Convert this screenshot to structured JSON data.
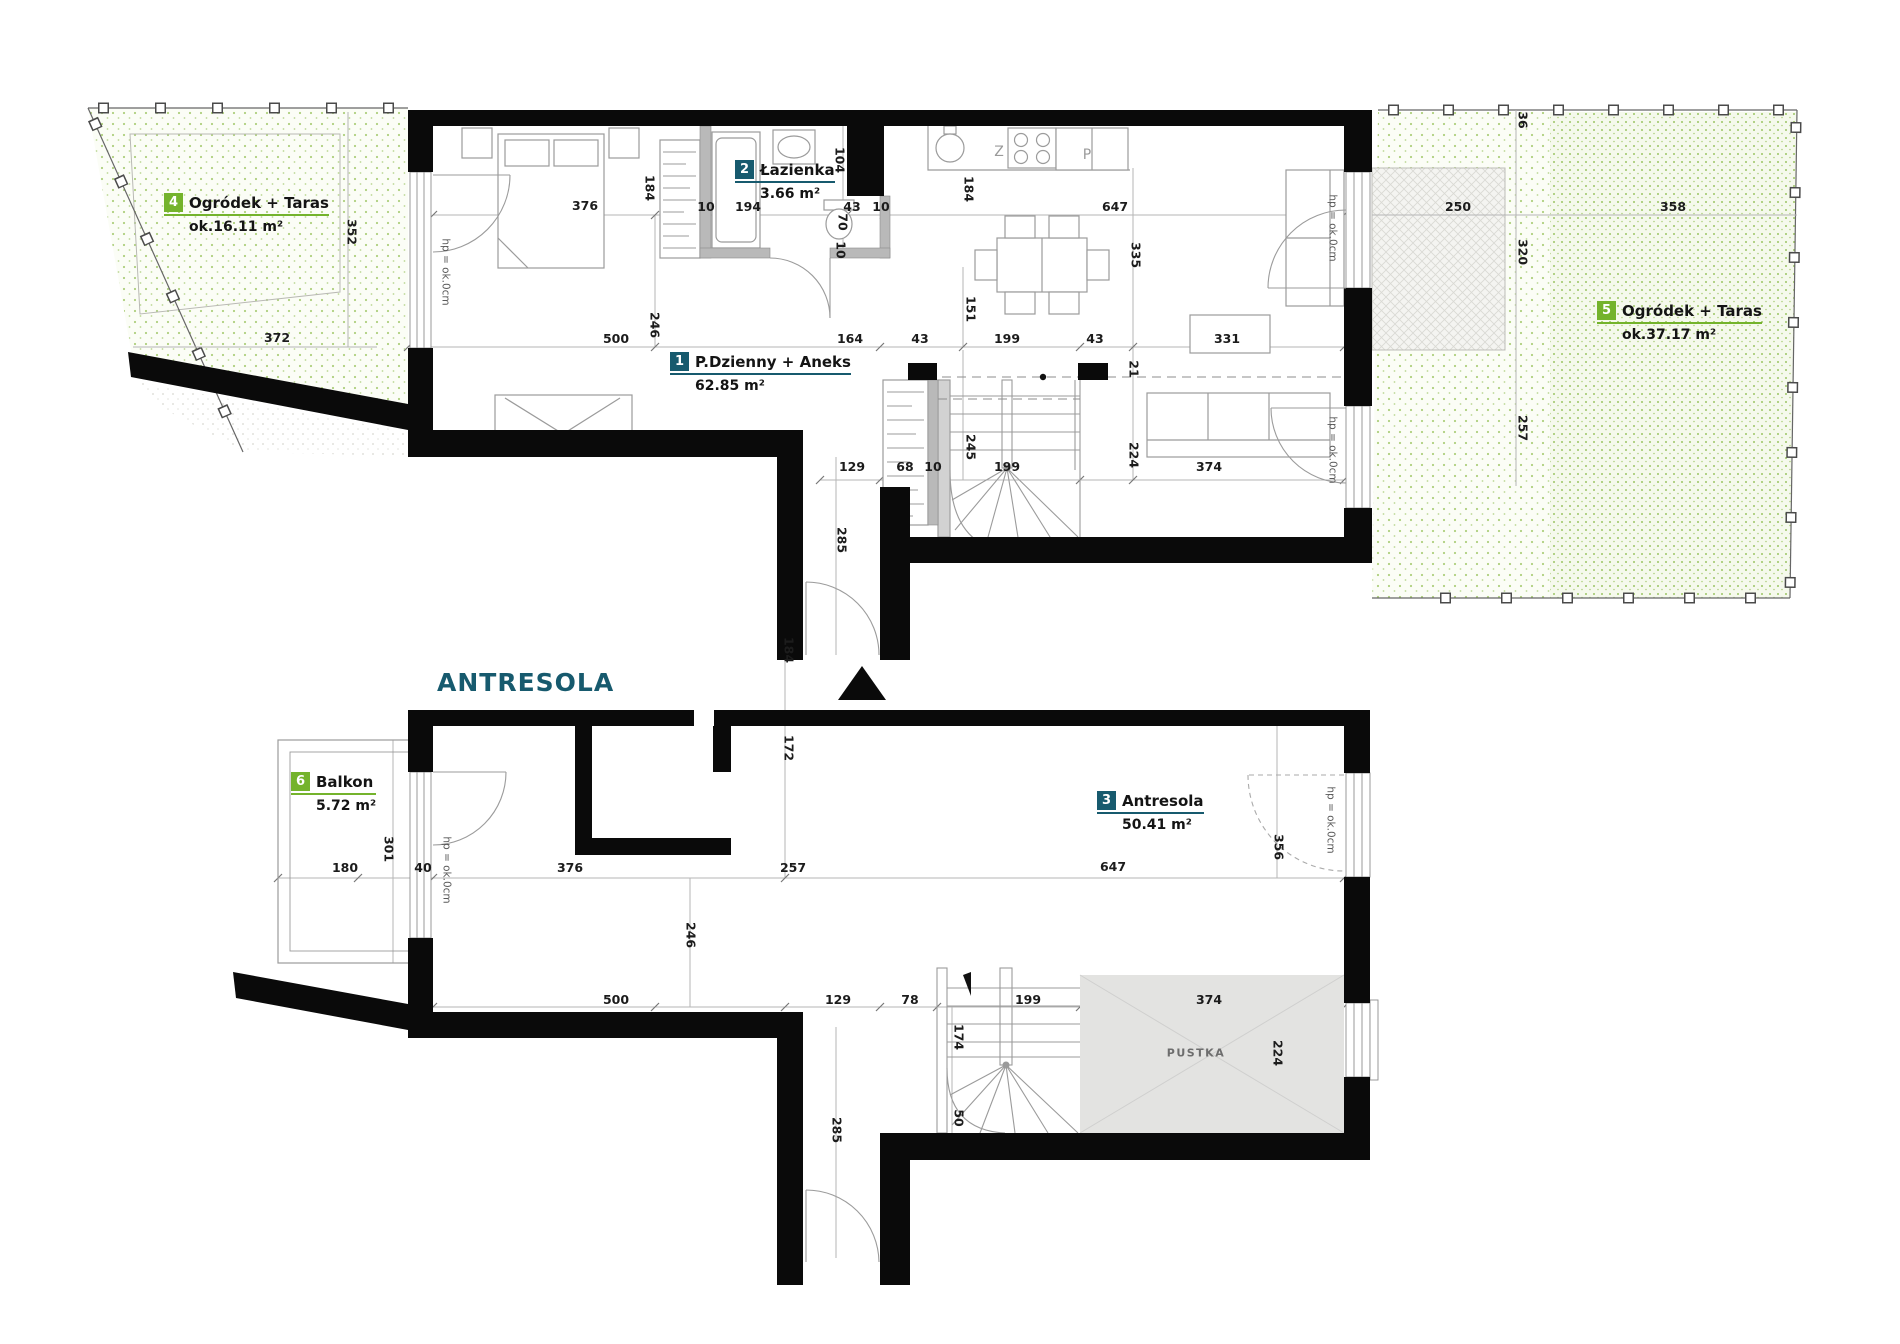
{
  "level_title": "ANTRESOLA",
  "colors": {
    "badge_green": "#74b32c",
    "badge_teal": "#175a6e",
    "wall": "#0a0a0a",
    "garden_dot": "#aecf7e",
    "pustka_fill": "#e3e3e1"
  },
  "rooms": {
    "r1": {
      "num": "1",
      "name": "P.Dzienny + Aneks",
      "area": "62.85 m²"
    },
    "r2": {
      "num": "2",
      "name": "Łazienka",
      "area": "3.66 m²"
    },
    "r3": {
      "num": "3",
      "name": "Antresola",
      "area": "50.41 m²"
    },
    "r4": {
      "num": "4",
      "name": "Ogródek + Taras",
      "area": "ok.16.11 m²"
    },
    "r5": {
      "num": "5",
      "name": "Ogródek + Taras",
      "area": "ok.37.17 m²"
    },
    "r6": {
      "num": "6",
      "name": "Balkon",
      "area": "5.72 m²"
    }
  },
  "labels": {
    "pustka": "PUSTKA",
    "hp": "hp = ok.0cm",
    "appliance_z": "Z",
    "appliance_p": "P"
  },
  "dims_upper": [
    "352",
    "372",
    "376",
    "184",
    "10",
    "194",
    "104",
    "43",
    "10",
    "184",
    "647",
    "335",
    "500",
    "246",
    "164",
    "43",
    "199",
    "43",
    "331",
    "151",
    "21",
    "245",
    "199",
    "224",
    "374",
    "129",
    "68",
    "10",
    "285",
    "70",
    "10",
    "36",
    "250",
    "358",
    "320",
    "257"
  ],
  "dims_lower": [
    "301",
    "180",
    "40",
    "376",
    "257",
    "647",
    "184",
    "172",
    "356",
    "246",
    "500",
    "129",
    "78",
    "199",
    "374",
    "174",
    "50",
    "285",
    "224"
  ]
}
